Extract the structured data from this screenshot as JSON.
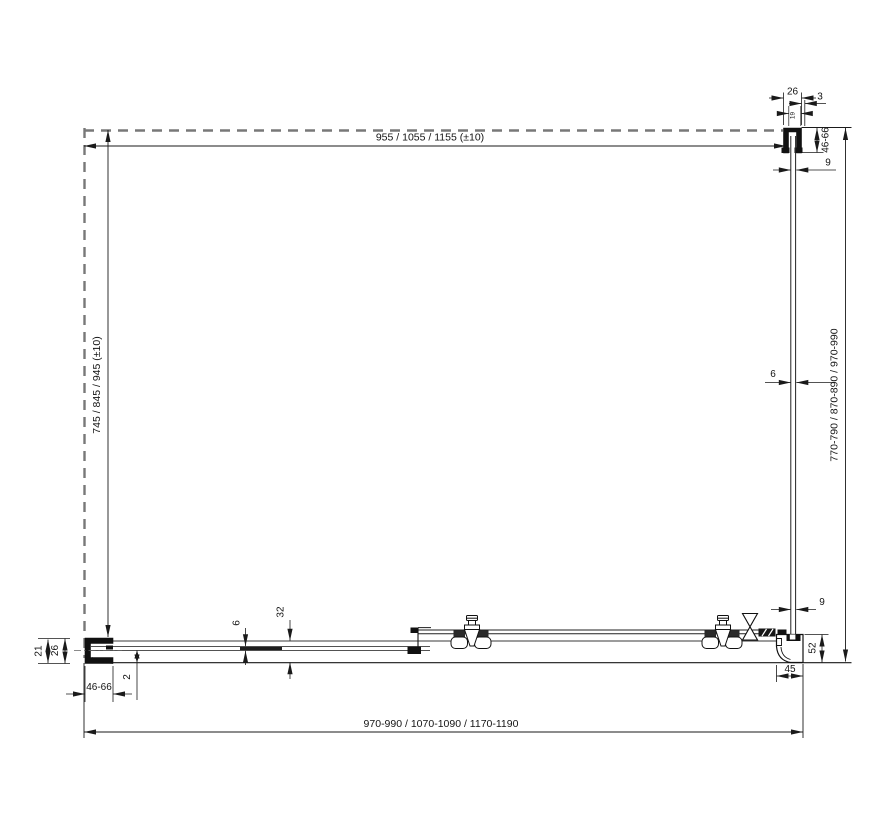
{
  "drawing": {
    "labels": {
      "top_width": "955 / 1055 / 1155 (±10)",
      "left_height": "745 / 845 / 945 (±10)",
      "right_height": "770-790 / 870-890 / 970-990",
      "bottom_width": "970-990 / 1070-1090 / 1170-1190",
      "top_profile_width": "26",
      "top_gap": "3",
      "top_profile_inner": "19",
      "top_adjustment": "46-66",
      "top_glass_offset": "9",
      "side_glass_thickness": "6",
      "bottom_glass_offset": "9",
      "corner_profile_height": "52",
      "corner_profile_depth": "45",
      "left_wall_clearance": "21",
      "left_profile_width": "26",
      "left_adjustment": "46-66",
      "rail_step": "2",
      "rail_glass_thickness": "6",
      "rail_section_height": "32"
    },
    "colors": {
      "line": "#1a1a1a",
      "dashed_wall": "#787878",
      "background": "#ffffff"
    }
  }
}
